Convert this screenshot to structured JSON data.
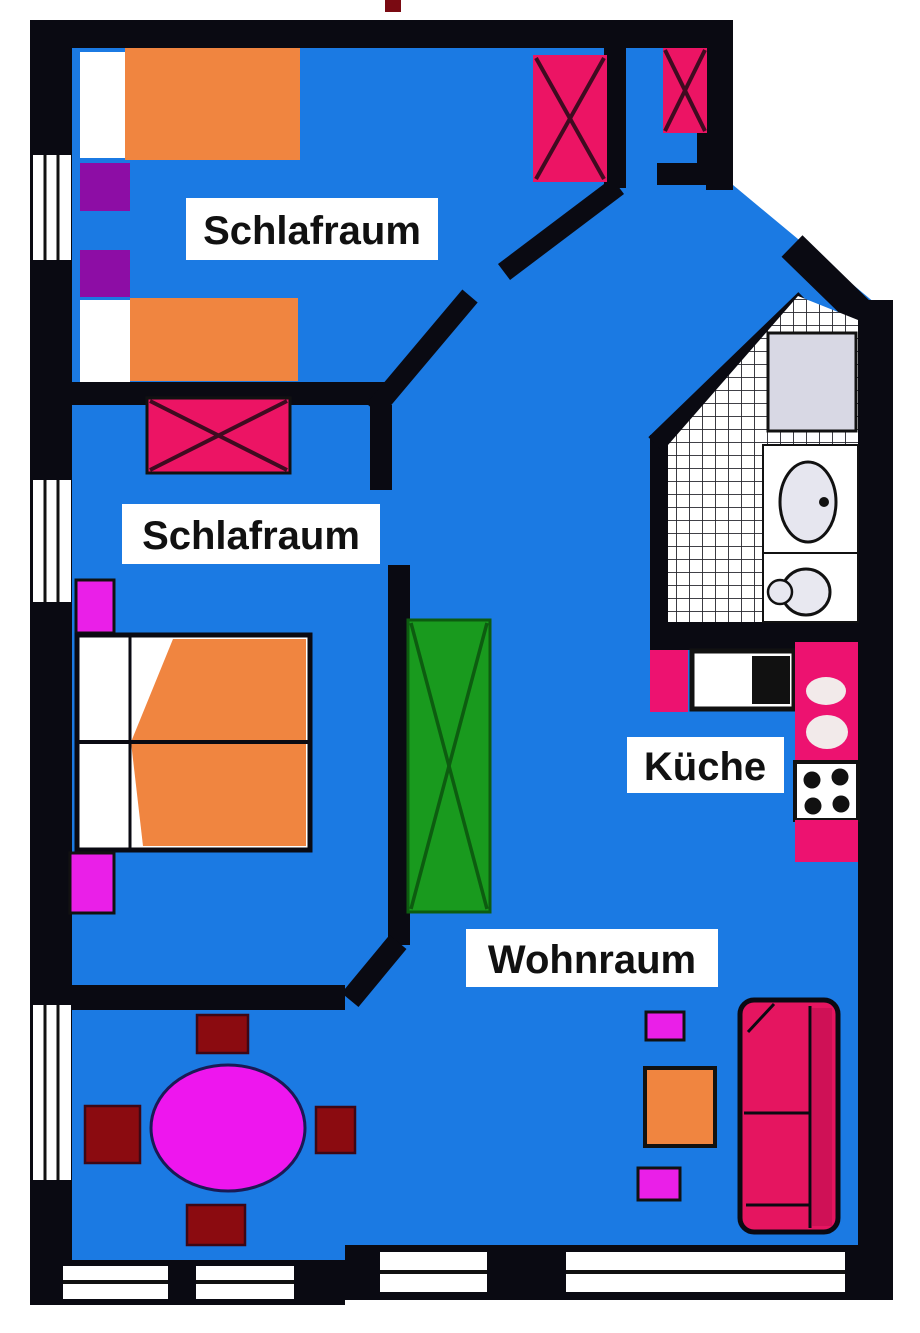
{
  "figure": {
    "type": "apartment-floor-plan"
  },
  "rooms": {
    "bedroom1": {
      "label": "Schlafraum"
    },
    "bedroom2": {
      "label": "Schlafraum"
    },
    "kitchen": {
      "label": "Küche"
    },
    "living_room": {
      "label": "Wohnraum"
    }
  },
  "palette": {
    "floor": "#1b7ae3",
    "wall": "#0a0a12",
    "bed_orange": "#f08540",
    "pillow_white": "#ffffff",
    "nightstand_purple": "#8d0da5",
    "nightstand_magenta": "#ea1fe8",
    "wardrobe_pink": "#ec1464",
    "wardrobe_green": "#199a1e",
    "dining_table_magenta": "#ee16ee",
    "chair_dark_red": "#8b0b10",
    "sofa_crimson": "#e51560",
    "kitchen_counter_pink": "#ed1270",
    "fixture_gray": "#d8d8e4",
    "window_white": "#ffffff",
    "label_bg": "#ffffff",
    "label_text": "#111111"
  }
}
